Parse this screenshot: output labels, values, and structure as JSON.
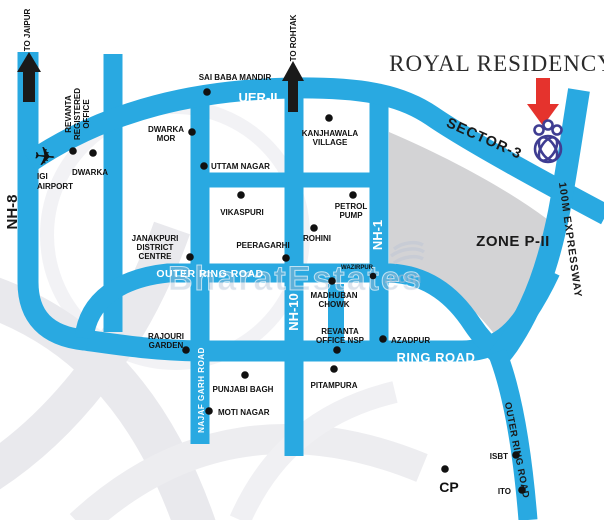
{
  "map": {
    "title": "ROYAL RESIDENCY",
    "colors": {
      "road": "#29A9E1",
      "zone": "#D3D3D5",
      "swirl": "#ECECEF",
      "dot": "#111111",
      "arrow_black": "#1a1a1a",
      "arrow_red": "#E5332D",
      "crest": "#3F3D92",
      "label": "#111111",
      "road_label": "#ffffff"
    },
    "directions": {
      "to_jaipur": "TO JAIPUR",
      "to_rohtak": "TO ROHTAK"
    },
    "road_labels": {
      "nh8": "NH-8",
      "uer2": "UER-II",
      "nh1": "NH-1",
      "nh10": "NH-10",
      "outer_ring_road": "OUTER RING ROAD",
      "ring_road": "RING ROAD",
      "najafgarh_road": "NAJAF GARH ROAD",
      "expressway": "100M EXPRESSWAY",
      "outer_ring_road_se": "OUTER RING ROAD",
      "sector3": "SECTOR-3",
      "zone": "ZONE P-II"
    },
    "places": {
      "revanta_registered": {
        "l1": "REVANTA",
        "l2": "REGISTERED",
        "l3": "OFFICE"
      },
      "igi_airport": {
        "l1": "IGI",
        "l2": "AIRPORT"
      },
      "dwarka": {
        "l1": "DWARKA"
      },
      "dwarka_mor": {
        "l1": "DWARKA",
        "l2": "MOR"
      },
      "sai_baba_mandir": {
        "l1": "SAI BABA MANDIR"
      },
      "kanjhawala_village": {
        "l1": "KANJHAWALA",
        "l2": "VILLAGE"
      },
      "uttam_nagar": {
        "l1": "UTTAM NAGAR"
      },
      "vikaspuri": {
        "l1": "VIKASPURI"
      },
      "petrol_pump": {
        "l1": "PETROL",
        "l2": "PUMP"
      },
      "rohini": {
        "l1": "ROHINI"
      },
      "janakpuri_district_centre": {
        "l1": "JANAKPURI",
        "l2": "DISTRICT",
        "l3": "CENTRE"
      },
      "peeragarhi": {
        "l1": "PEERAGARHI"
      },
      "wazirpur": {
        "l1": "WAZIRPUR"
      },
      "madhuban_chowk": {
        "l1": "MADHUBAN",
        "l2": "CHOWK"
      },
      "revanta_office_nsp": {
        "l1": "REVANTA",
        "l2": "OFFICE NSP"
      },
      "azadpur": {
        "l1": "AZADPUR"
      },
      "pitampura": {
        "l1": "PITAMPURA"
      },
      "rajouri_garden": {
        "l1": "RAJOURI",
        "l2": "GARDEN"
      },
      "punjabi_bagh": {
        "l1": "PUNJABI BAGH"
      },
      "moti_nagar": {
        "l1": "MOTI NAGAR"
      },
      "isbt": {
        "l1": "ISBT"
      },
      "ito": {
        "l1": "ITO"
      },
      "cp": {
        "l1": "CP"
      }
    },
    "watermark": {
      "text": "BharatEstates",
      "suffix": ".com"
    },
    "icons": {
      "airplane": "✈"
    }
  }
}
